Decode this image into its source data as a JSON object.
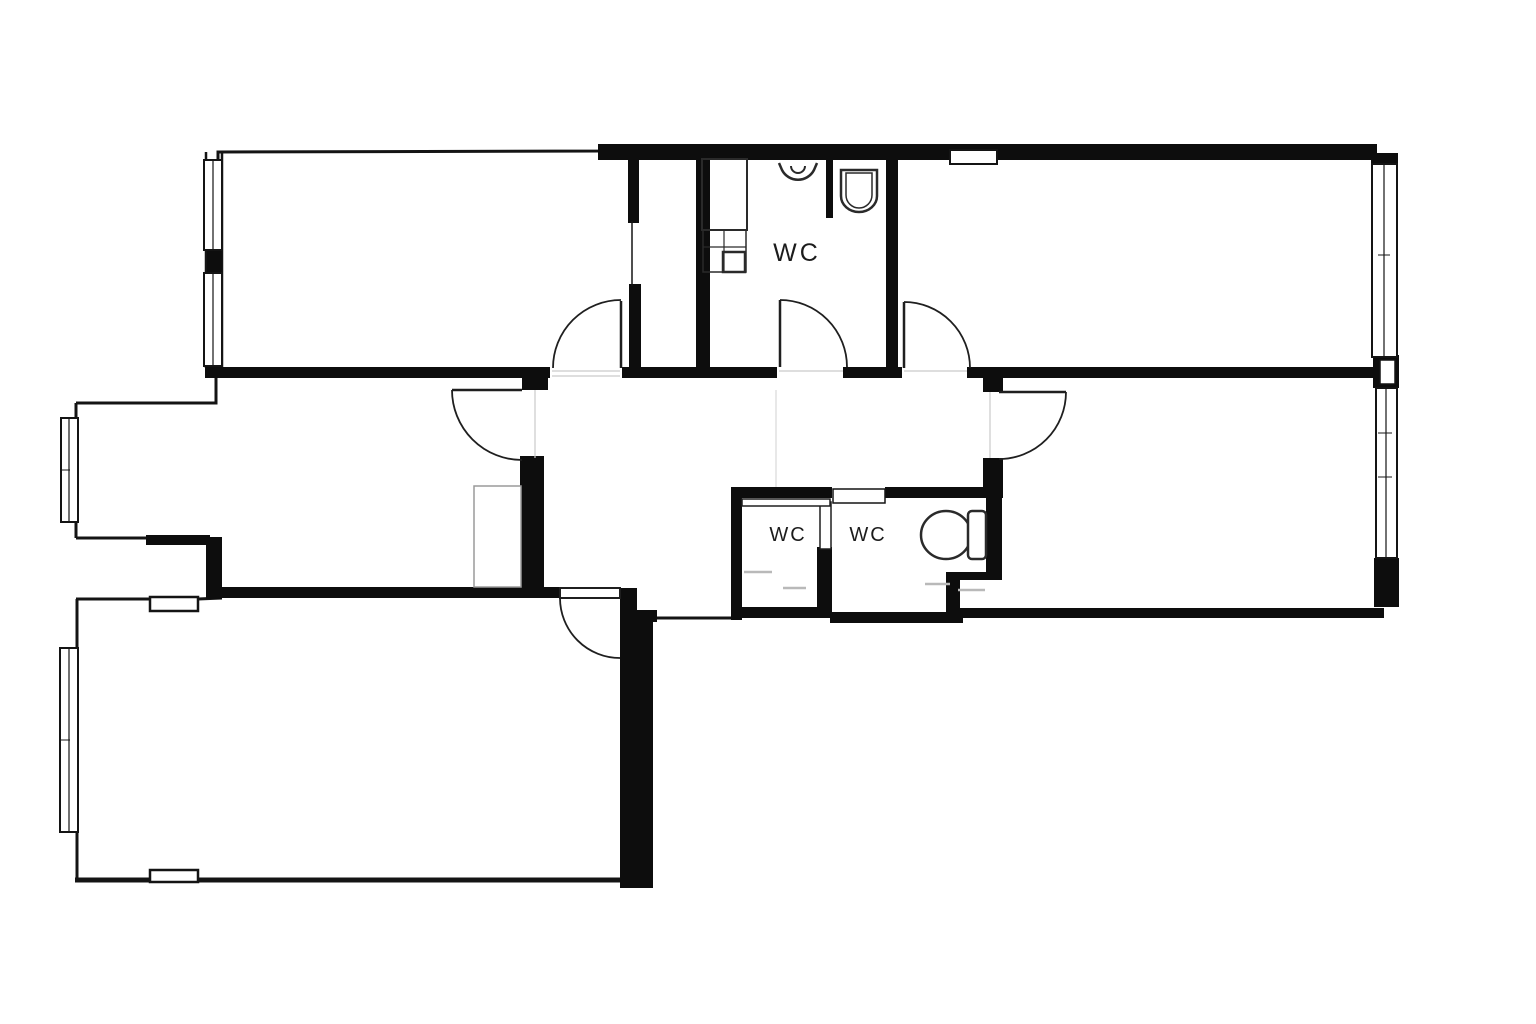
{
  "plan": {
    "type": "apartment-floor-plan",
    "labels": {
      "wc_top": "WC",
      "wc_mid_left": "WC",
      "wc_mid_right": "WC"
    },
    "colors": {
      "background": "#ffffff",
      "wall_fill": "#0d0d0d",
      "thin_wall_line": "#141414",
      "door_line": "#1f1f1f",
      "fixture_line": "#2a2a2a",
      "closet_line": "#9a9a9a",
      "floor_dash": "#b9b9b9",
      "threshold_line": "#c9c9c9"
    },
    "features": {
      "rooms": [
        "top-left-room",
        "top-right-room",
        "middle-left-room",
        "middle-right-room",
        "bottom-left-room",
        "hall",
        "wc-top",
        "wc-mid-left",
        "wc-mid-right",
        "closet-strip"
      ],
      "door_count": 8,
      "window_count": 6,
      "fixtures": [
        "sink",
        "toilet-top",
        "toilet-right",
        "appliance-block",
        "wardrobe"
      ]
    }
  }
}
